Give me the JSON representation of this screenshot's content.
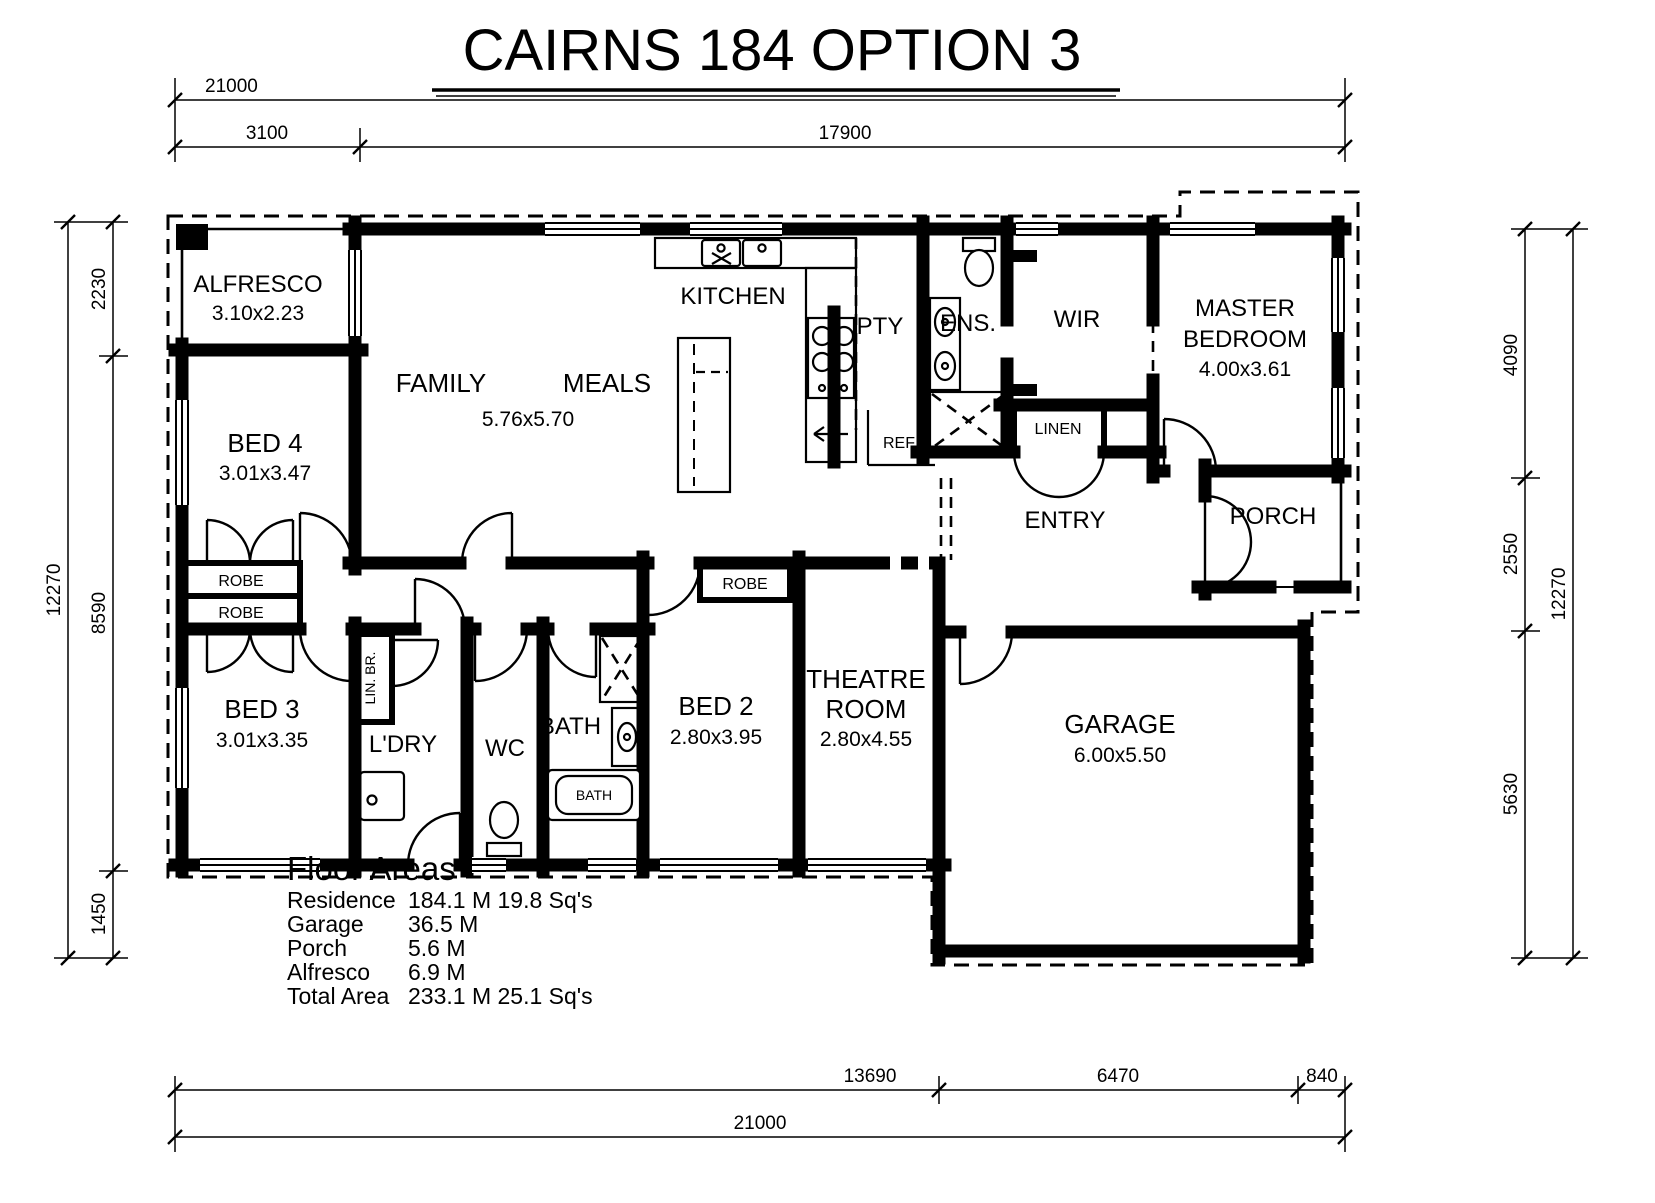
{
  "title": "CAIRNS 184 OPTION 3",
  "dims": {
    "top_total": "21000",
    "top_left": "3100",
    "top_right": "17900",
    "left_total": "12270",
    "left_top": "2230",
    "left_mid": "8590",
    "left_bot": "1450",
    "right_top": "4090",
    "right_mid": "2550",
    "right_bot": "5630",
    "right_total": "12270",
    "bot_left": "13690",
    "bot_mid": "6470",
    "bot_right": "840",
    "bot_total": "21000"
  },
  "rooms": {
    "alfresco": {
      "name": "ALFRESCO",
      "size": "3.10x2.23"
    },
    "bed4": {
      "name": "BED 4",
      "size": "3.01x3.47"
    },
    "family": {
      "name": "FAMILY"
    },
    "meals": {
      "name": "MEALS"
    },
    "family_meals": {
      "size": "5.76x5.70"
    },
    "kitchen": {
      "name": "KITCHEN"
    },
    "pty": {
      "name": "PTY"
    },
    "ens": {
      "name": "ENS."
    },
    "wir": {
      "name": "WIR"
    },
    "master": {
      "line1": "MASTER",
      "line2": "BEDROOM",
      "size": "4.00x3.61"
    },
    "entry": {
      "name": "ENTRY"
    },
    "porch": {
      "name": "PORCH"
    },
    "linen": {
      "name": "LINEN"
    },
    "ref": {
      "name": "REF"
    },
    "robe": {
      "name": "ROBE"
    },
    "bed3": {
      "name": "BED 3",
      "size": "3.01x3.35"
    },
    "lin_br": {
      "name": "LIN. BR."
    },
    "ldry": {
      "name": "L'DRY"
    },
    "wc": {
      "name": "WC"
    },
    "bath": {
      "name": "BATH",
      "tub": "BATH"
    },
    "bed2": {
      "name": "BED 2",
      "size": "2.80x3.95"
    },
    "theatre": {
      "line1": "THEATRE",
      "line2": "ROOM",
      "size": "2.80x4.55"
    },
    "garage": {
      "name": "GARAGE",
      "size": "6.00x5.50"
    }
  },
  "floor_areas": {
    "heading": "Floor Areas",
    "rows": [
      {
        "label": "Residence",
        "value": "184.1 M 19.8 Sq's"
      },
      {
        "label": "Garage",
        "value": "36.5 M"
      },
      {
        "label": "Porch",
        "value": "5.6 M"
      },
      {
        "label": "Alfresco",
        "value": "6.9 M"
      },
      {
        "label": "Total Area",
        "value": "233.1 M 25.1 Sq's"
      }
    ]
  }
}
